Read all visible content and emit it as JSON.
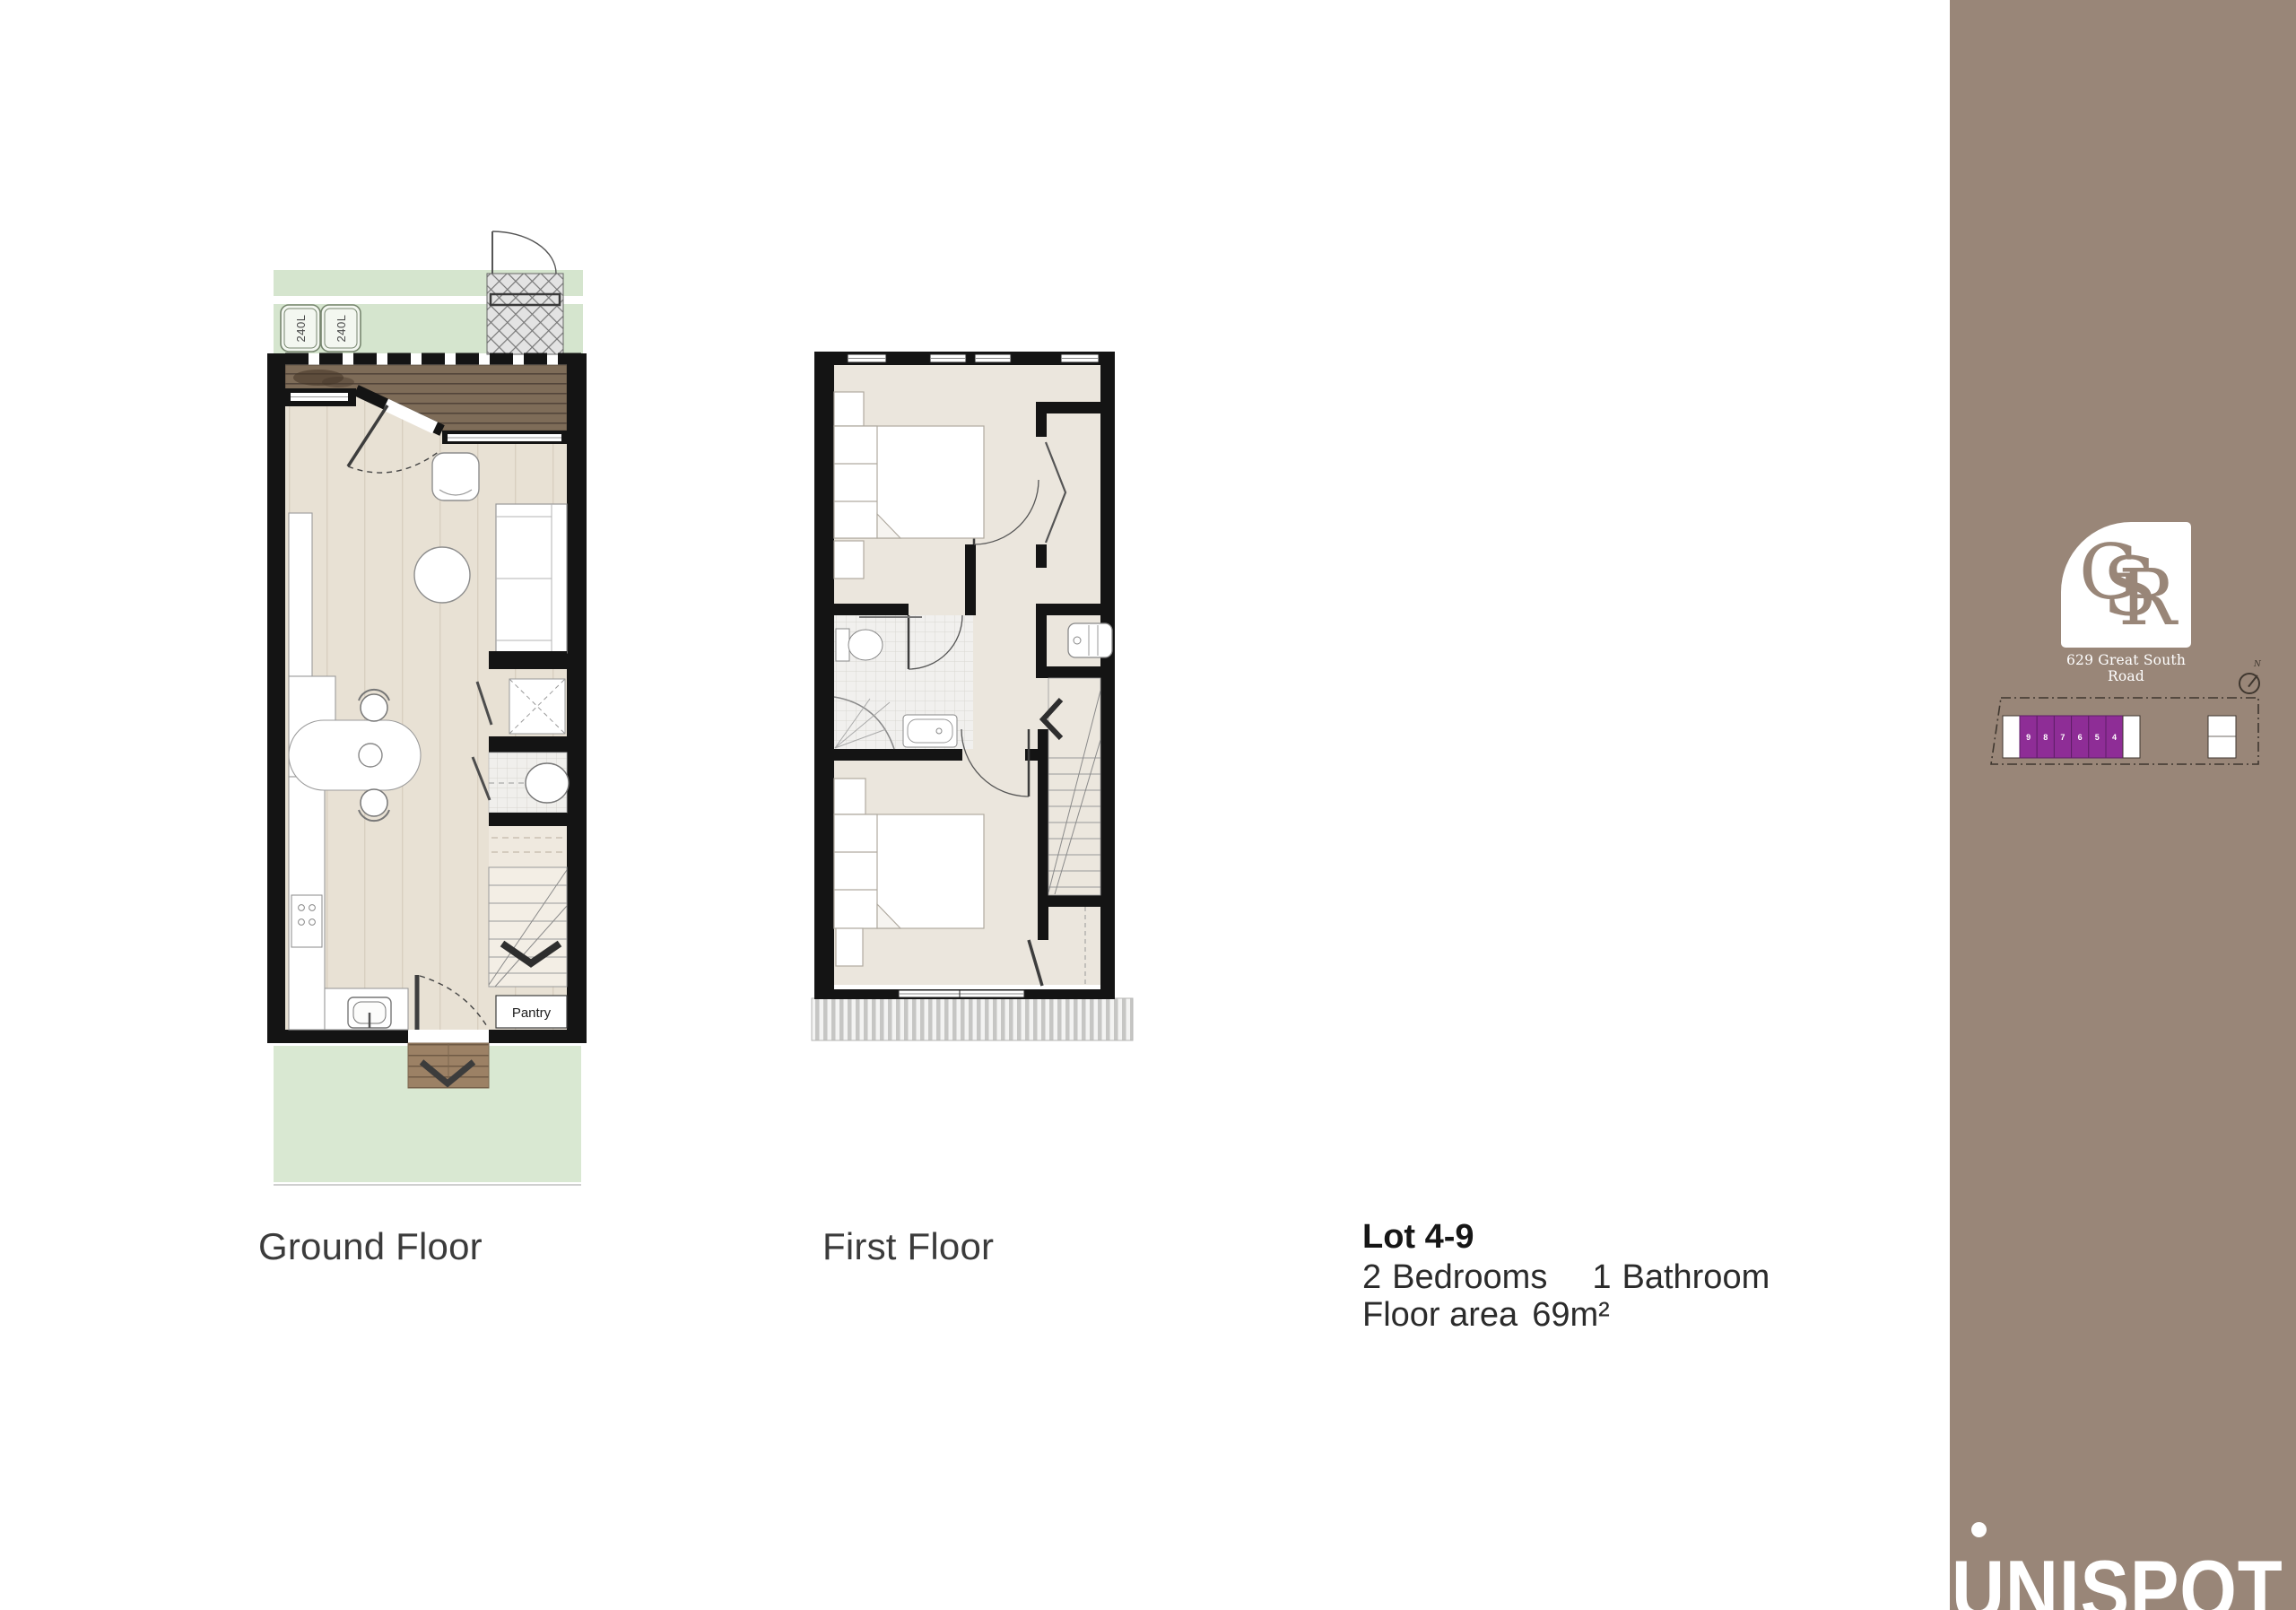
{
  "colors": {
    "sidebar": "#998678",
    "unit_highlight": "#8e2d96",
    "wall": "#141414",
    "deck_wood": "#7e6c58",
    "floor_wood": "#e8e1d4",
    "lawn": "#d5e5ce"
  },
  "plans": {
    "ground": {
      "label": "Ground Floor",
      "bin_labels": [
        "240L",
        "240L"
      ],
      "pantry_label": "Pantry"
    },
    "first": {
      "label": "First Floor"
    }
  },
  "lot": {
    "title": "Lot 4-9",
    "bedrooms_count": "2",
    "bedrooms_label": "Bedrooms",
    "bathrooms_count": "1",
    "bathrooms_label": "Bathroom",
    "area_label": "Floor area",
    "area_value": "69m²"
  },
  "sidebar": {
    "logo": {
      "letters": [
        "G",
        "S",
        "R"
      ],
      "address": "629 Great South Road"
    },
    "compass_label": "N",
    "site_plan": {
      "unit_numbers": [
        "9",
        "8",
        "7",
        "6",
        "5",
        "4"
      ]
    },
    "brand": "UNISPOT"
  }
}
